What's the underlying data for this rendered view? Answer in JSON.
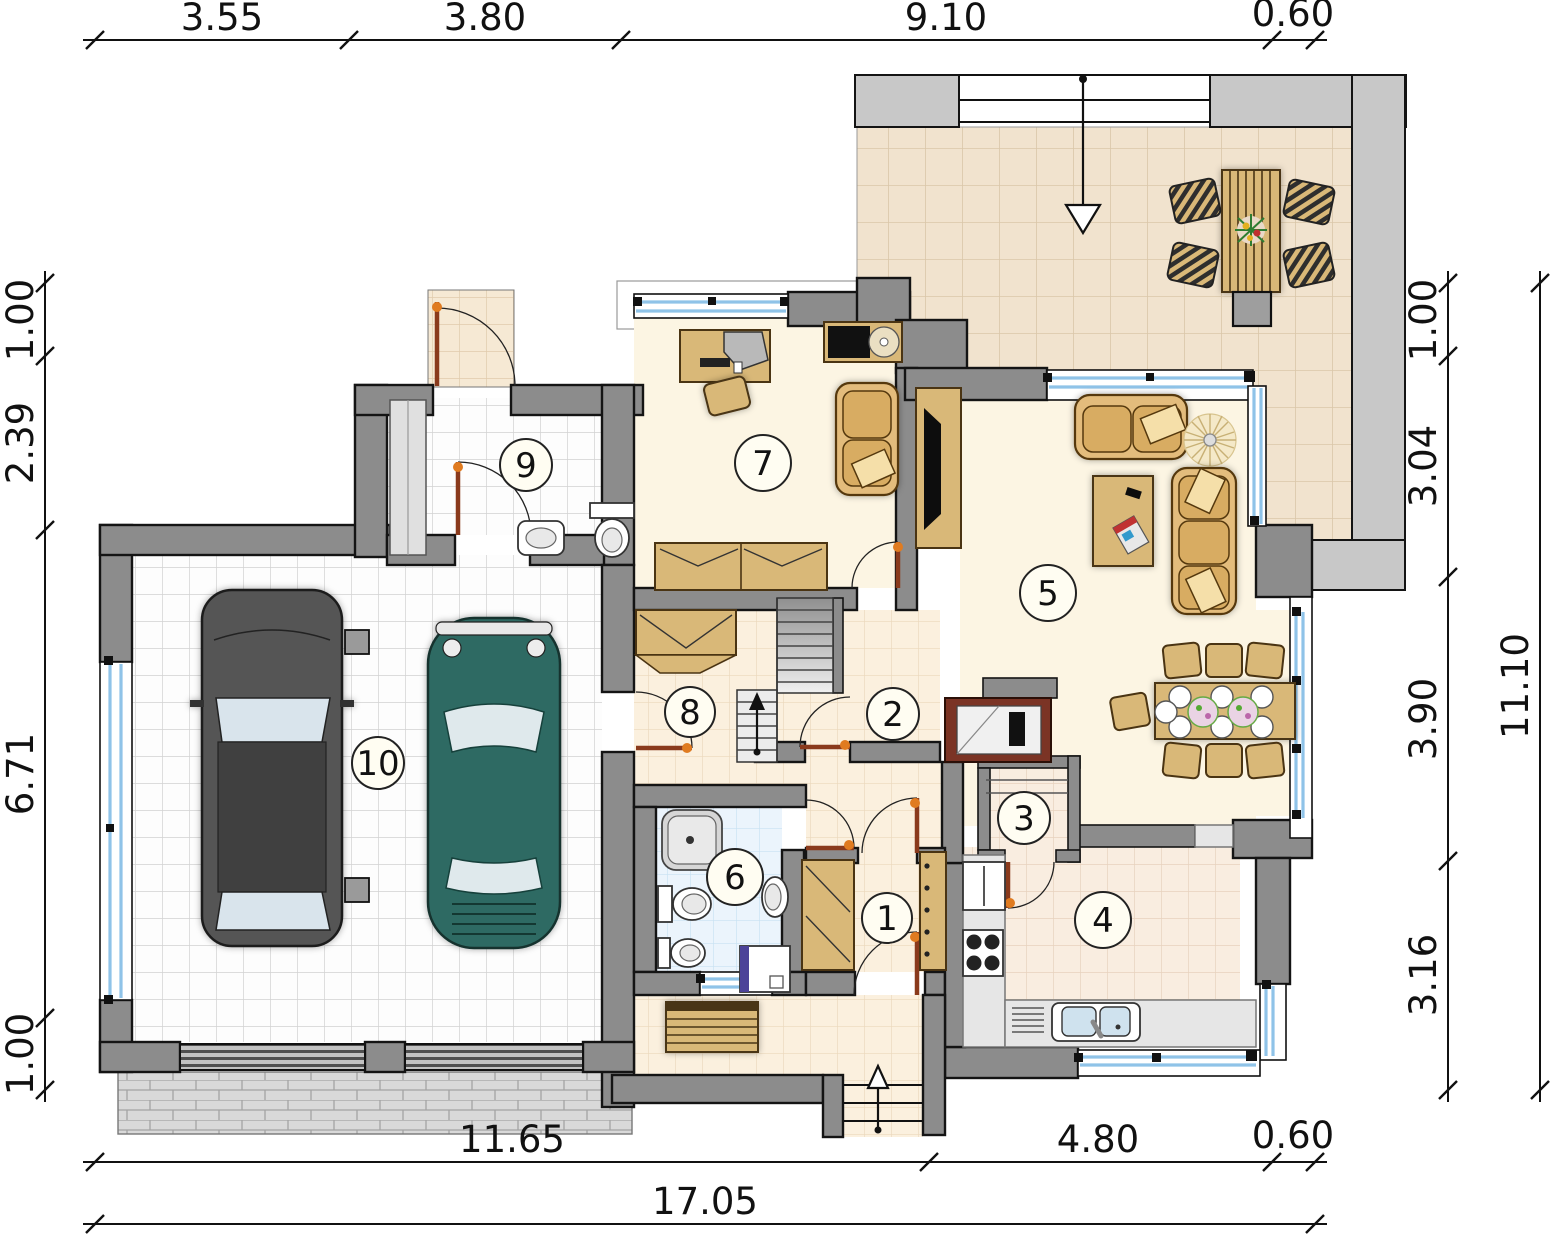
{
  "title": "house-ground-floor-plan",
  "dimensions": {
    "top": [
      "3.55",
      "3.80",
      "9.10",
      "0.60"
    ],
    "left": [
      "1.00",
      "2.39",
      "6.71",
      "1.00"
    ],
    "right": [
      "1.00",
      "3.04",
      "3.90",
      "3.16"
    ],
    "right_total": "11.10",
    "bottom": [
      "11.65",
      "4.80",
      "0.60"
    ],
    "bottom_total": "17.05"
  },
  "rooms": [
    {
      "number": "1"
    },
    {
      "number": "2"
    },
    {
      "number": "3"
    },
    {
      "number": "4"
    },
    {
      "number": "5"
    },
    {
      "number": "6"
    },
    {
      "number": "7"
    },
    {
      "number": "8"
    },
    {
      "number": "9"
    },
    {
      "number": "10"
    }
  ],
  "colors": {
    "wall": "#8C8C8C",
    "parapet": "#C8C8C8",
    "wood": "#D9B878",
    "sofa": "#E3BC7C",
    "window_blue": "#8FC3E8",
    "door_leaf": "#8A3A1C",
    "hinge": "#E07B20",
    "car_dark": "#555555",
    "car_teal": "#2F6B63",
    "floor_cream": "#FCF5E3"
  }
}
